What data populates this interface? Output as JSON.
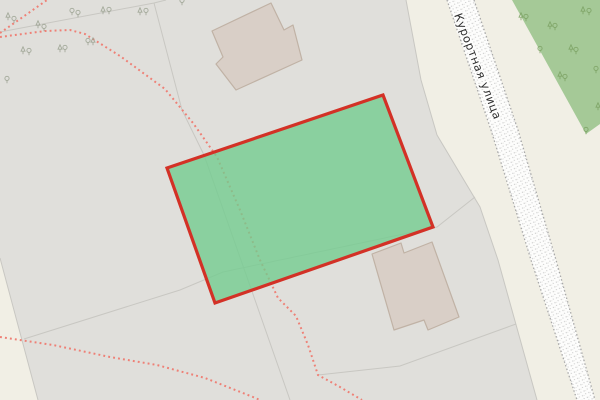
{
  "canvas": {
    "width": 600,
    "height": 400
  },
  "road_label": {
    "text": "Курортная улица",
    "x": 454,
    "y": 15,
    "rotation": 69,
    "font_size": 11.4
  },
  "colors": {
    "background": "#e0dfdb",
    "parcel_beige": "#f1efe5",
    "forest_green": "#a5c997",
    "selected_fill": "#72cc8e",
    "selected_fill_opacity": 0.78,
    "selected_border": "#d33126",
    "building_fill": "#d9cfc7",
    "building_stroke": "#c0b2a5",
    "boundary_line": "#c8c7c2",
    "footpath_red": "#ee8076",
    "road_fill": "#fdfdfc",
    "road_edge": "#a8a8a8",
    "road_speckle": "#c2c2c2",
    "label_color": "#2f2f2f",
    "label_halo": "#ffffff",
    "tree_gray": "#99a08f",
    "tree_green": "#7aa061"
  },
  "features": {
    "beige_areas": [
      [
        [
          406,
          0
        ],
        [
          600,
          0
        ],
        [
          600,
          400
        ],
        [
          537,
          400
        ],
        [
          498,
          260
        ],
        [
          480,
          207
        ],
        [
          437,
          135
        ],
        [
          421,
          80
        ]
      ],
      [
        [
          0,
          258
        ],
        [
          38,
          400
        ],
        [
          0,
          400
        ]
      ]
    ],
    "forest": [
      [
        512,
        0
      ],
      [
        600,
        0
      ],
      [
        600,
        124
      ],
      [
        586,
        134
      ]
    ],
    "boundary_lines": [
      [
        [
          0,
          32
        ],
        [
          154,
          3
        ],
        [
          166,
          0
        ]
      ],
      [
        [
          154,
          3
        ],
        [
          182,
          110
        ],
        [
          204,
          155
        ],
        [
          255,
          300
        ],
        [
          290,
          400
        ]
      ],
      [
        [
          24,
          339
        ],
        [
          180,
          290
        ],
        [
          223,
          272
        ],
        [
          437,
          227
        ],
        [
          475,
          197
        ]
      ],
      [
        [
          318,
          375
        ],
        [
          400,
          366
        ],
        [
          516,
          324
        ]
      ],
      [
        [
          406,
          0
        ],
        [
          421,
          80
        ],
        [
          437,
          135
        ],
        [
          480,
          207
        ],
        [
          498,
          260
        ],
        [
          537,
          400
        ]
      ],
      [
        [
          0,
          258
        ],
        [
          38,
          400
        ]
      ]
    ],
    "footpaths": [
      [
        [
          0,
          33
        ],
        [
          47,
          0
        ]
      ],
      [
        [
          0,
          37
        ],
        [
          45,
          31
        ],
        [
          70,
          30
        ],
        [
          85,
          34
        ],
        [
          120,
          56
        ],
        [
          165,
          89
        ],
        [
          193,
          123
        ],
        [
          217,
          157
        ],
        [
          240,
          210
        ],
        [
          260,
          260
        ],
        [
          278,
          298
        ],
        [
          296,
          316
        ],
        [
          308,
          345
        ],
        [
          318,
          375
        ],
        [
          340,
          387
        ],
        [
          362,
          400
        ]
      ],
      [
        [
          0,
          337
        ],
        [
          53,
          345
        ],
        [
          110,
          357
        ],
        [
          157,
          365
        ],
        [
          205,
          378
        ],
        [
          253,
          397
        ],
        [
          260,
          400
        ]
      ]
    ],
    "selected_parcel": [
      [
        167,
        168
      ],
      [
        383,
        95
      ],
      [
        433,
        227
      ],
      [
        215,
        303
      ]
    ],
    "buildings": [
      [
        [
          271,
          3
        ],
        [
          284,
          30
        ],
        [
          293,
          25
        ],
        [
          302,
          60
        ],
        [
          236,
          90
        ],
        [
          216,
          64
        ],
        [
          223,
          57
        ],
        [
          212,
          31
        ]
      ],
      [
        [
          372,
          254
        ],
        [
          401,
          243
        ],
        [
          404,
          253
        ],
        [
          432,
          242
        ],
        [
          459,
          317
        ],
        [
          428,
          330
        ],
        [
          424,
          320
        ],
        [
          394,
          330
        ]
      ]
    ],
    "road": {
      "left": [
        [
          447,
          0
        ],
        [
          491,
          130
        ],
        [
          531,
          260
        ],
        [
          577,
          400
        ]
      ],
      "right": [
        [
          474,
          0
        ],
        [
          518,
          130
        ],
        [
          556,
          260
        ],
        [
          595,
          400
        ]
      ]
    },
    "trees_gray": [
      {
        "x": 8,
        "y": 18,
        "t": "c"
      },
      {
        "x": 14,
        "y": 21,
        "t": "d"
      },
      {
        "x": 38,
        "y": 26,
        "t": "c"
      },
      {
        "x": 44,
        "y": 29,
        "t": "d"
      },
      {
        "x": 72,
        "y": 13,
        "t": "d"
      },
      {
        "x": 78,
        "y": 15,
        "t": "d"
      },
      {
        "x": 103,
        "y": 12,
        "t": "c"
      },
      {
        "x": 109,
        "y": 12,
        "t": "d"
      },
      {
        "x": 140,
        "y": 13,
        "t": "c"
      },
      {
        "x": 146,
        "y": 13,
        "t": "d"
      },
      {
        "x": 88,
        "y": 43,
        "t": "d"
      },
      {
        "x": 93,
        "y": 43,
        "t": "c"
      },
      {
        "x": 23,
        "y": 52,
        "t": "c"
      },
      {
        "x": 29,
        "y": 53,
        "t": "d"
      },
      {
        "x": 60,
        "y": 50,
        "t": "c"
      },
      {
        "x": 65,
        "y": 50,
        "t": "d"
      },
      {
        "x": 7,
        "y": 81,
        "t": "d"
      },
      {
        "x": 182,
        "y": 3,
        "t": "d"
      }
    ],
    "trees_green": [
      {
        "x": 521,
        "y": 18,
        "t": "c"
      },
      {
        "x": 526,
        "y": 19,
        "t": "d"
      },
      {
        "x": 550,
        "y": 27,
        "t": "c"
      },
      {
        "x": 555,
        "y": 28,
        "t": "d"
      },
      {
        "x": 583,
        "y": 12,
        "t": "c"
      },
      {
        "x": 589,
        "y": 13,
        "t": "d"
      },
      {
        "x": 540,
        "y": 51,
        "t": "d"
      },
      {
        "x": 571,
        "y": 50,
        "t": "c"
      },
      {
        "x": 576,
        "y": 52,
        "t": "d"
      },
      {
        "x": 560,
        "y": 77,
        "t": "c"
      },
      {
        "x": 565,
        "y": 79,
        "t": "d"
      },
      {
        "x": 596,
        "y": 71,
        "t": "d"
      },
      {
        "x": 586,
        "y": 132,
        "t": "d"
      },
      {
        "x": 598,
        "y": 108,
        "t": "c"
      }
    ]
  }
}
